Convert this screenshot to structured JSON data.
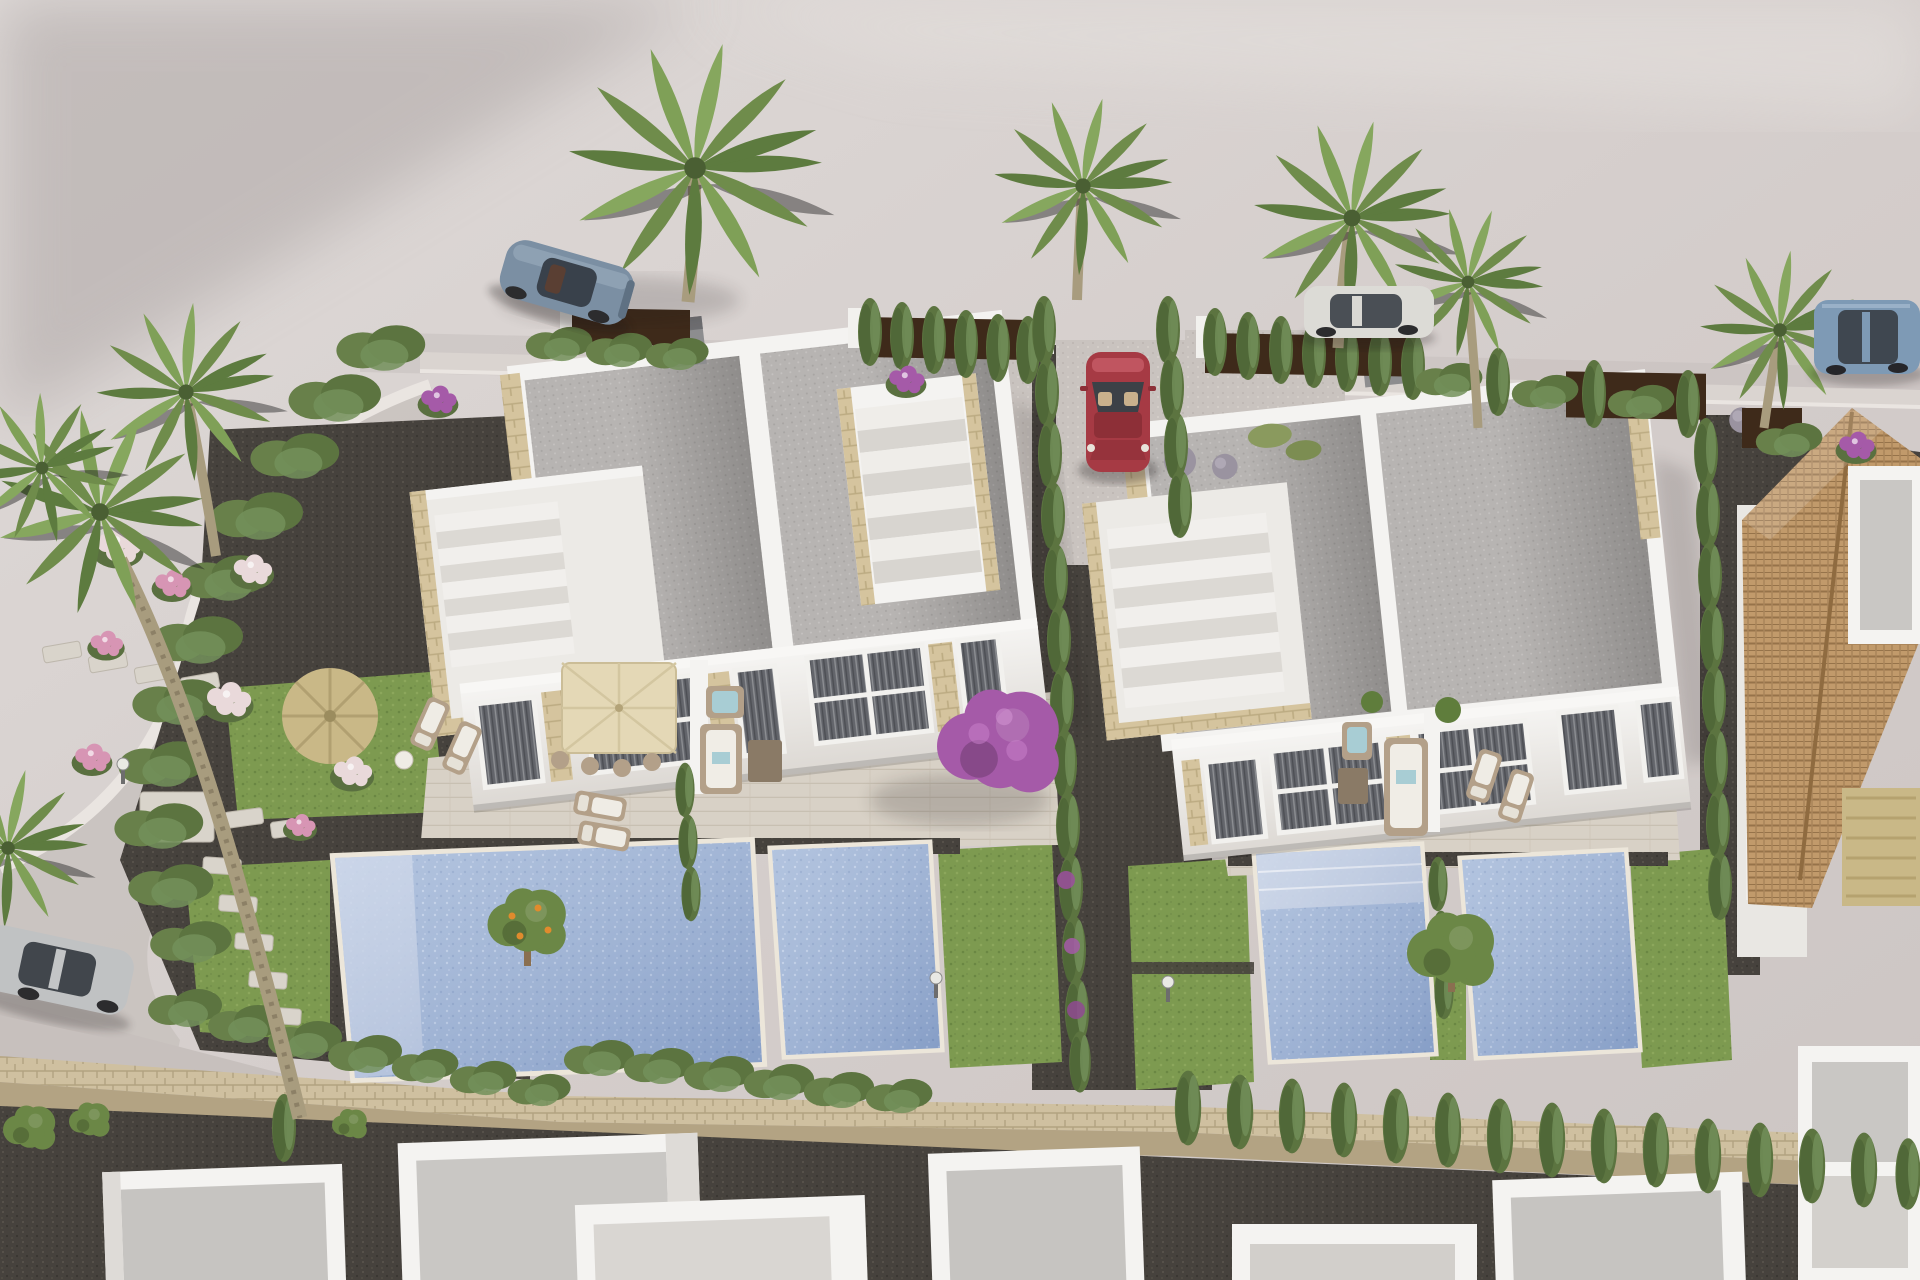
{
  "meta": {
    "title": "Aerial 3D architectural rendering — modern villa development",
    "media_type": "computer-generated real-estate render",
    "view": "high-angle aerial, late-afternoon light from upper left",
    "no_visible_text": true
  },
  "palette": {
    "ground": "#d4cdcb",
    "ground_light": "#ded9d6",
    "ground_shadow": "#aba3a2",
    "road": "#c7c0bd",
    "sidewalk": "#dad4d0",
    "curb": "#eae5e1",
    "white_wall": "#f4f3f1",
    "white_shade": "#dedbd7",
    "roof_gravel": "#b7b4b2",
    "roof_shade": "#9c9997",
    "roof_terrace": "#eceae6",
    "terrace_floor": "#d8d1c6",
    "stone_accent": "#d5c49e",
    "stone_wall": "#cfc0a0",
    "stone_wall_dark": "#b3a383",
    "window_dark": "#63656b",
    "window_stripe": "#8e9094",
    "gravel_dark": "#46423d",
    "gravel_light": "#c9c3bf",
    "lawn": "#7d9a50",
    "lawn_dark": "#6a8743",
    "hedge": "#68804a",
    "cypress": "#5c7440",
    "cypress_dark": "#4e6536",
    "cypress_light": "#73905a",
    "pool_water": "#a2b7d8",
    "pool_deep": "#8aa2c8",
    "pool_steps": "#c6d1e6",
    "umbrella": "#e4d8b6",
    "palapa": "#c9b887",
    "corten": "#3e2a1a",
    "chimney": "#8d8d8f",
    "tile_roof": "#c19a6b",
    "bougainvillea": "#a55aa8",
    "flower_pink": "#d795b4",
    "flower_white": "#e9d9da",
    "tree_green": "#6b8746",
    "car_coupe": "#7b8fa3",
    "car_red": "#a63a44",
    "car_white": "#dcdbd6",
    "car_suv": "#7e9ab5",
    "car_silver": "#c0c2c3",
    "wood_furniture": "#b3a089",
    "cushion_teal": "#a8cdd4"
  },
  "scene": {
    "description": "Two modern white semi-detached villas with flat gravel roofs, travertine parapet accents, roof terraces with exterior stairs, large curtained windows, ground-floor terraces with parasols and lounge furniture, four private pools and lawns; dark gravel drives with cypress hedges, corten fence panels along the street, palms and flowering shrubs; a terracotta-tile-roof house on the right; a row of white flat-roofed houses behind a stone wall at the bottom; five parked cars.",
    "objects": [
      "left-villa",
      "right-villa",
      "tiled-roof-house",
      "bottom-row-houses",
      "pool-a",
      "pool-b",
      "pool-c",
      "pool-d",
      "beige-parasol",
      "palapa-umbrella",
      "outdoor-sofa-sets",
      "sun-loungers",
      "cypress-hedges",
      "boundary-hedge",
      "bougainvillea-tree",
      "orange-tree",
      "palm-trees",
      "flower-bushes",
      "stepping-stones",
      "stone-wall",
      "corten-fence-panels",
      "blue-grey-coupe",
      "red-car",
      "white-sedan",
      "blue-suv",
      "silver-hatchback",
      "garden-lamps",
      "street-and-sidewalk"
    ]
  }
}
